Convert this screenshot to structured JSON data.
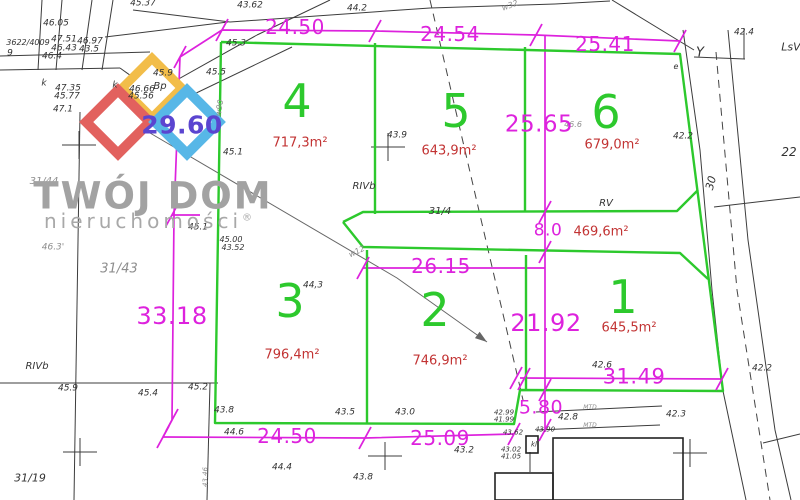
{
  "canvas": {
    "w": 800,
    "h": 500
  },
  "logo": {
    "title": "TWÓJ DOM",
    "subtitle": "nieruchomości",
    "reg": "®",
    "title_pos": {
      "x": 153,
      "y": 196
    },
    "subtitle_pos": {
      "x": 148,
      "y": 221
    },
    "diamonds": [
      {
        "name": "yellow-diamond",
        "color": "#f2bd49",
        "cx": 152,
        "cy": 88,
        "s": 42,
        "w": 9
      },
      {
        "name": "red-diamond",
        "color": "#e2615e",
        "cx": 118,
        "cy": 122,
        "s": 45,
        "w": 10
      },
      {
        "name": "blue-diamond",
        "color": "#57b7e7",
        "cx": 187,
        "cy": 122,
        "s": 45,
        "w": 10
      }
    ]
  },
  "plots": [
    {
      "number": "4",
      "x": 297,
      "y": 101,
      "area": "717,3m²",
      "ax": 300,
      "ay": 143
    },
    {
      "number": "5",
      "x": 456,
      "y": 111,
      "area": "643,9m²",
      "ax": 449,
      "ay": 151
    },
    {
      "number": "6",
      "x": 606,
      "y": 112,
      "area": "679,0m²",
      "ax": 612,
      "ay": 145
    },
    {
      "number": "3",
      "x": 290,
      "y": 301,
      "area": "796,4m²",
      "ax": 292,
      "ay": 355
    },
    {
      "number": "2",
      "x": 435,
      "y": 310,
      "area": "746,9m²",
      "ax": 440,
      "ay": 361
    },
    {
      "number": "1",
      "x": 623,
      "y": 297,
      "area": "645,5m²",
      "ax": 629,
      "ay": 328
    }
  ],
  "road_area": {
    "area": "469,6m²",
    "ax": 601,
    "ay": 232
  },
  "dimensions": [
    {
      "t": "24.50",
      "x": 295,
      "y": 27,
      "s": 20
    },
    {
      "t": "24.54",
      "x": 450,
      "y": 34,
      "s": 20
    },
    {
      "t": "25.41",
      "x": 605,
      "y": 44,
      "s": 20
    },
    {
      "t": "25.65",
      "x": 539,
      "y": 125,
      "s": 23
    },
    {
      "t": "29.60",
      "x": 182,
      "y": 125,
      "s": 25,
      "c": "#5b45d0",
      "w": 700
    },
    {
      "t": "33.18",
      "x": 172,
      "y": 316,
      "s": 24
    },
    {
      "t": "26.15",
      "x": 441,
      "y": 266,
      "s": 20
    },
    {
      "t": "21.92",
      "x": 546,
      "y": 323,
      "s": 24
    },
    {
      "t": "8.0",
      "x": 548,
      "y": 231,
      "s": 17
    },
    {
      "t": "24.50",
      "x": 287,
      "y": 436,
      "s": 20
    },
    {
      "t": "25.09",
      "x": 440,
      "y": 438,
      "s": 20
    },
    {
      "t": "31.49",
      "x": 634,
      "y": 377,
      "s": 21
    },
    {
      "t": "5.80",
      "x": 541,
      "y": 408,
      "s": 19
    }
  ],
  "survey_labels": [
    {
      "t": "45.37",
      "x": 143,
      "y": 4
    },
    {
      "t": "46.05",
      "x": 56,
      "y": 24
    },
    {
      "t": "3622/4009",
      "x": 28,
      "y": 43,
      "s": 8
    },
    {
      "t": "47.51",
      "x": 64,
      "y": 40
    },
    {
      "t": "46.97",
      "x": 90,
      "y": 42
    },
    {
      "t": "46.43",
      "x": 64,
      "y": 49
    },
    {
      "t": "43.5",
      "x": 89,
      "y": 50
    },
    {
      "t": "9",
      "x": 10,
      "y": 54
    },
    {
      "t": "46.4",
      "x": 52,
      "y": 57
    },
    {
      "t": "47.35",
      "x": 68,
      "y": 89
    },
    {
      "t": "45.77",
      "x": 67,
      "y": 97
    },
    {
      "t": "47.1",
      "x": 63,
      "y": 110
    },
    {
      "t": "k",
      "x": 44,
      "y": 84
    },
    {
      "t": "k",
      "x": 115,
      "y": 86
    },
    {
      "t": "46.66",
      "x": 142,
      "y": 90
    },
    {
      "t": "45.56",
      "x": 141,
      "y": 97
    },
    {
      "t": "Bp",
      "x": 160,
      "y": 87,
      "s": 10
    },
    {
      "t": "45.9",
      "x": 163,
      "y": 74
    },
    {
      "t": "45.3",
      "x": 236,
      "y": 44
    },
    {
      "t": "45.5",
      "x": 216,
      "y": 73
    },
    {
      "t": "43.62",
      "x": 250,
      "y": 6
    },
    {
      "t": "44.2",
      "x": 357,
      "y": 9
    },
    {
      "t": "w32",
      "x": 510,
      "y": 6,
      "r": -20,
      "c": "gr",
      "s": 8
    },
    {
      "t": "42.4",
      "x": 744,
      "y": 33
    },
    {
      "t": "LsV",
      "x": 791,
      "y": 47,
      "s": 11
    },
    {
      "t": "Y",
      "x": 700,
      "y": 53,
      "s": 13
    },
    {
      "t": "22",
      "x": 789,
      "y": 152,
      "s": 12
    },
    {
      "t": "30",
      "x": 711,
      "y": 183,
      "r": -75,
      "s": 11
    },
    {
      "t": "42.2",
      "x": 683,
      "y": 137
    },
    {
      "t": "45.1",
      "x": 233,
      "y": 153
    },
    {
      "t": "45.1",
      "x": 198,
      "y": 228
    },
    {
      "t": "w90",
      "x": 220,
      "y": 108,
      "r": -80,
      "c": "gr",
      "s": 8
    },
    {
      "t": "w12",
      "x": 357,
      "y": 252,
      "r": -25,
      "c": "gr",
      "s": 8
    },
    {
      "t": "43.9",
      "x": 397,
      "y": 136
    },
    {
      "t": "RIVb",
      "x": 364,
      "y": 187,
      "s": 10
    },
    {
      "t": "31/4",
      "x": 440,
      "y": 212,
      "s": 10
    },
    {
      "t": "RV",
      "x": 606,
      "y": 204,
      "s": 10
    },
    {
      "t": "46.6",
      "x": 573,
      "y": 125,
      "c": "gr",
      "s": 8
    },
    {
      "t": "e",
      "x": 676,
      "y": 67,
      "s": 8
    },
    {
      "t": "46.3'",
      "x": 53,
      "y": 248,
      "c": "gr"
    },
    {
      "t": "31/44",
      "x": 44,
      "y": 182,
      "c": "gr",
      "s": 10
    },
    {
      "t": "31/43",
      "x": 119,
      "y": 269,
      "c": "gr",
      "s": 13
    },
    {
      "t": "45.00",
      "x": 231,
      "y": 240,
      "s": 8
    },
    {
      "t": "43.52",
      "x": 233,
      "y": 248,
      "s": 8
    },
    {
      "t": "44,3",
      "x": 313,
      "y": 286
    },
    {
      "t": "RIVb",
      "x": 37,
      "y": 367,
      "s": 10
    },
    {
      "t": "45.9",
      "x": 68,
      "y": 389
    },
    {
      "t": "45.4",
      "x": 148,
      "y": 394
    },
    {
      "t": "45.2",
      "x": 198,
      "y": 388
    },
    {
      "t": "31/19",
      "x": 30,
      "y": 478,
      "s": 11
    },
    {
      "t": "43.8",
      "x": 224,
      "y": 411
    },
    {
      "t": "44.6",
      "x": 234,
      "y": 433
    },
    {
      "t": "43.5",
      "x": 345,
      "y": 413
    },
    {
      "t": "43.0",
      "x": 405,
      "y": 413
    },
    {
      "t": "43.2",
      "x": 464,
      "y": 451
    },
    {
      "t": "44.4",
      "x": 282,
      "y": 468
    },
    {
      "t": "43.8",
      "x": 363,
      "y": 478
    },
    {
      "t": "42.99",
      "x": 504,
      "y": 413,
      "s": 7
    },
    {
      "t": "41.99",
      "x": 504,
      "y": 420,
      "s": 7
    },
    {
      "t": "43.62",
      "x": 513,
      "y": 433,
      "s": 7
    },
    {
      "t": "43.02",
      "x": 511,
      "y": 450,
      "s": 7
    },
    {
      "t": "41.05",
      "x": 511,
      "y": 457,
      "s": 7
    },
    {
      "t": "43.90",
      "x": 545,
      "y": 430,
      "s": 7
    },
    {
      "t": "kl",
      "x": 534,
      "y": 445,
      "s": 7
    },
    {
      "t": "42.8",
      "x": 568,
      "y": 418
    },
    {
      "t": "42.3",
      "x": 676,
      "y": 415
    },
    {
      "t": "42.6",
      "x": 602,
      "y": 366
    },
    {
      "t": "42.2",
      "x": 762,
      "y": 369
    },
    {
      "t": "43.46",
      "x": 206,
      "y": 477,
      "r": -90,
      "s": 7,
      "c": "gr"
    },
    {
      "t": "MTD",
      "x": 590,
      "y": 408,
      "s": 6,
      "c": "gr"
    },
    {
      "t": "MTD",
      "x": 590,
      "y": 426,
      "s": 6,
      "c": "gr"
    }
  ],
  "geometry": {
    "black_lines": [
      [
        0,
        56,
        150,
        52
      ],
      [
        0,
        70,
        120,
        68
      ],
      [
        120,
        68,
        176,
        108
      ],
      [
        42,
        0,
        38,
        70
      ],
      [
        62,
        0,
        56,
        70
      ],
      [
        92,
        0,
        82,
        70
      ],
      [
        113,
        0,
        102,
        70
      ],
      [
        133,
        10,
        230,
        22
      ],
      [
        105,
        37,
        228,
        22
      ],
      [
        150,
        95,
        257,
        35
      ],
      [
        165,
        108,
        292,
        47
      ],
      [
        257,
        35,
        330,
        0
      ],
      [
        230,
        22,
        430,
        8
      ],
      [
        430,
        8,
        555,
        4
      ],
      [
        555,
        4,
        610,
        1
      ],
      [
        612,
        0,
        694,
        50
      ],
      [
        694,
        57,
        745,
        59
      ],
      [
        744,
        28,
        744,
        59
      ],
      [
        80,
        112,
        74,
        500
      ],
      [
        0,
        383,
        218,
        383
      ],
      [
        210,
        383,
        207,
        500
      ],
      [
        714,
        207,
        800,
        197
      ],
      [
        763,
        443,
        800,
        434
      ],
      [
        536,
        412,
        662,
        406
      ],
      [
        536,
        430,
        660,
        425
      ],
      [
        530,
        452,
        530,
        472
      ]
    ],
    "black_polylines": [
      [
        683,
        30,
        700,
        150,
        712,
        290,
        723,
        391,
        746,
        500
      ],
      [
        728,
        30,
        748,
        240,
        775,
        430,
        791,
        500
      ]
    ],
    "dashed_lines": [
      [
        430,
        0,
        523,
        400
      ],
      [
        716,
        52,
        737,
        290,
        770,
        500
      ]
    ],
    "gray_lines": [
      [
        150,
        133,
        397,
        278,
        487,
        342
      ]
    ],
    "crosses": [
      [
        79,
        145
      ],
      [
        388,
        147
      ],
      [
        80,
        452
      ],
      [
        385,
        456
      ],
      [
        690,
        453
      ]
    ],
    "rects": [
      [
        553,
        438,
        130,
        62
      ],
      [
        495,
        473,
        58,
        27
      ],
      [
        526,
        436,
        12,
        17
      ]
    ],
    "green": [
      [
        221,
        42,
        680,
        54,
        723,
        391,
        520,
        390,
        514,
        424,
        215,
        423,
        221,
        42
      ],
      [
        375,
        43,
        375,
        214
      ],
      [
        525,
        47,
        525,
        211
      ],
      [
        343,
        222,
        363,
        212,
        677,
        211,
        698,
        190
      ],
      [
        343,
        222,
        363,
        247,
        680,
        253,
        708,
        279
      ],
      [
        367,
        250,
        367,
        423
      ],
      [
        526,
        255,
        526,
        390
      ]
    ],
    "magenta": [
      [
        180,
        57,
        222,
        30,
        375,
        31,
        536,
        35,
        680,
        41
      ],
      [
        180,
        57,
        174,
        215,
        172,
        420,
        163,
        437
      ],
      [
        172,
        215,
        200,
        215
      ],
      [
        545,
        35,
        545,
        432
      ],
      [
        363,
        268,
        545,
        268
      ],
      [
        163,
        437,
        365,
        438,
        514,
        434
      ],
      [
        520,
        378,
        722,
        379
      ]
    ],
    "ticks": [
      [
        222,
        30
      ],
      [
        375,
        31
      ],
      [
        536,
        35
      ],
      [
        680,
        41
      ],
      [
        180,
        57
      ],
      [
        172,
        215
      ],
      [
        172,
        420
      ],
      [
        545,
        212
      ],
      [
        545,
        252
      ],
      [
        545,
        390
      ],
      [
        545,
        430
      ],
      [
        363,
        268
      ],
      [
        163,
        437
      ],
      [
        365,
        438
      ],
      [
        514,
        434
      ],
      [
        516,
        378
      ],
      [
        524,
        379
      ],
      [
        722,
        379
      ]
    ],
    "arrow": {
      "x": 487,
      "y": 342,
      "angle": 36
    }
  }
}
